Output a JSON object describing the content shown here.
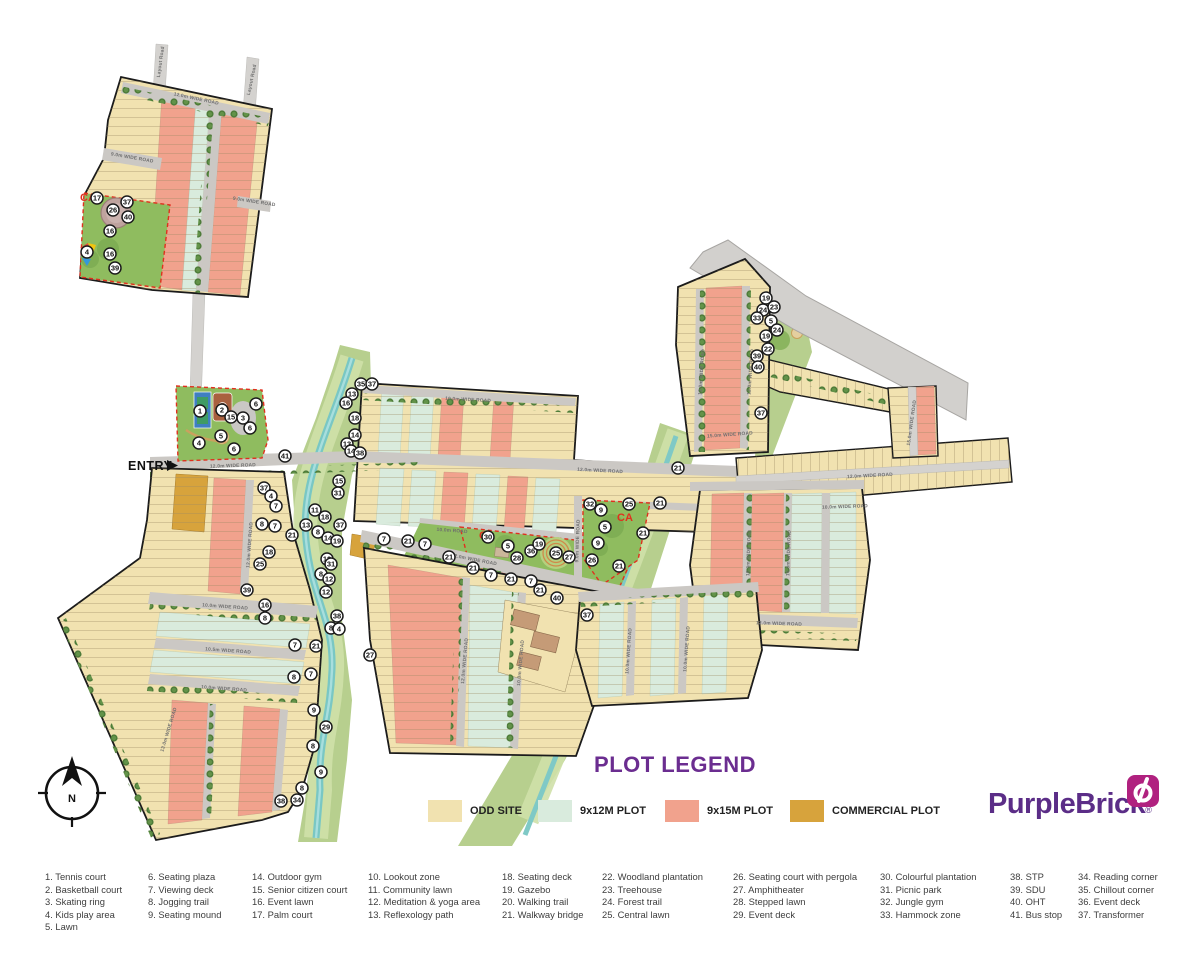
{
  "plot_legend": {
    "title": "PLOT LEGEND",
    "items": [
      {
        "label": "ODD SITE",
        "color": "#F1E2B0"
      },
      {
        "label": "9x12M PLOT",
        "color": "#D9EBDD"
      },
      {
        "label": "9x15M PLOT",
        "color": "#F1A28D"
      },
      {
        "label": "COMMERCIAL PLOT",
        "color": "#D7A33C"
      }
    ]
  },
  "brand": {
    "name": "PurpleBrick",
    "registered": "®",
    "purple": "#5B2D87",
    "magenta": "#B0217F"
  },
  "map": {
    "entry_label": "ENTRY",
    "north_label": "N",
    "ca_label": "CA",
    "ca_positions": [
      {
        "x": 80,
        "y": 201
      },
      {
        "x": 479,
        "y": 539
      },
      {
        "x": 617,
        "y": 521
      }
    ],
    "road_labels": [
      {
        "text": "Layout Road",
        "x": 162,
        "y": 62,
        "rot": -82
      },
      {
        "text": "Layout Road",
        "x": 253,
        "y": 80,
        "rot": -78
      },
      {
        "text": "12.0m WIDE ROAD",
        "x": 196,
        "y": 100,
        "rot": 12
      },
      {
        "text": "9.0m WIDE ROAD",
        "x": 132,
        "y": 159,
        "rot": 10
      },
      {
        "text": "9.0m WIDE ROAD",
        "x": 254,
        "y": 203,
        "rot": 9
      },
      {
        "text": "12.0m WIDE ROAD",
        "x": 233,
        "y": 467,
        "rot": -2
      },
      {
        "text": "12.0m WIDE ROAD",
        "x": 600,
        "y": 472,
        "rot": 3
      },
      {
        "text": "10.0m WIDE ROAD",
        "x": 468,
        "y": 401,
        "rot": 3
      },
      {
        "text": "12.0m WIDE ROAD",
        "x": 870,
        "y": 477,
        "rot": -3
      },
      {
        "text": "10.0m WIDE ROAD",
        "x": 845,
        "y": 508,
        "rot": -2
      },
      {
        "text": "10.0m ROAD",
        "x": 452,
        "y": 532,
        "rot": 4
      },
      {
        "text": "12.0m WIDE ROAD",
        "x": 474,
        "y": 561,
        "rot": 11
      },
      {
        "text": "10.0m WIDE ROAD",
        "x": 225,
        "y": 608,
        "rot": 4
      },
      {
        "text": "10.5m WIDE ROAD",
        "x": 228,
        "y": 652,
        "rot": 4
      },
      {
        "text": "10.0m WIDE ROAD",
        "x": 224,
        "y": 690,
        "rot": 4
      },
      {
        "text": "12.0m WIDE ROAD",
        "x": 251,
        "y": 545,
        "rot": -86
      },
      {
        "text": "13.0m WIDE ROAD",
        "x": 170,
        "y": 730,
        "rot": -73
      },
      {
        "text": "10.0m WIDE ROAD",
        "x": 750,
        "y": 553,
        "rot": -88
      },
      {
        "text": "10.0m WIDE ROAD",
        "x": 790,
        "y": 553,
        "rot": -88
      },
      {
        "text": "12.0m WIDE ROAD",
        "x": 779,
        "y": 625,
        "rot": 2
      },
      {
        "text": "12.0m WIDE ROAD",
        "x": 703,
        "y": 372,
        "rot": -86
      },
      {
        "text": "12.0m WIDE ROAD",
        "x": 752,
        "y": 372,
        "rot": -86
      },
      {
        "text": "15.0m WIDE ROAD",
        "x": 913,
        "y": 423,
        "rot": -82
      },
      {
        "text": "15.0m WIDE ROAD",
        "x": 730,
        "y": 436,
        "rot": -4
      },
      {
        "text": "10.0m WIDE ROAD",
        "x": 630,
        "y": 651,
        "rot": -86
      },
      {
        "text": "10.0m WIDE ROAD",
        "x": 688,
        "y": 649,
        "rot": -86
      },
      {
        "text": "12.0m WIDE ROAD",
        "x": 466,
        "y": 661,
        "rot": -85
      },
      {
        "text": "10.0m WIDE ROAD",
        "x": 522,
        "y": 663,
        "rot": -85
      },
      {
        "text": "9.0m WIDE ROAD",
        "x": 579,
        "y": 541,
        "rot": -88
      }
    ],
    "markers": [
      {
        "n": 17,
        "x": 97,
        "y": 198
      },
      {
        "n": 37,
        "x": 127,
        "y": 202
      },
      {
        "n": 26,
        "x": 113,
        "y": 210
      },
      {
        "n": 40,
        "x": 128,
        "y": 217
      },
      {
        "n": 16,
        "x": 110,
        "y": 231
      },
      {
        "n": 4,
        "x": 87,
        "y": 252
      },
      {
        "n": 16,
        "x": 110,
        "y": 254
      },
      {
        "n": 39,
        "x": 115,
        "y": 268
      },
      {
        "n": 1,
        "x": 200,
        "y": 411
      },
      {
        "n": 2,
        "x": 222,
        "y": 410
      },
      {
        "n": 15,
        "x": 231,
        "y": 417
      },
      {
        "n": 3,
        "x": 243,
        "y": 418
      },
      {
        "n": 6,
        "x": 256,
        "y": 404
      },
      {
        "n": 6,
        "x": 250,
        "y": 428
      },
      {
        "n": 4,
        "x": 199,
        "y": 443
      },
      {
        "n": 5,
        "x": 221,
        "y": 436
      },
      {
        "n": 6,
        "x": 234,
        "y": 449
      },
      {
        "n": 41,
        "x": 285,
        "y": 456
      },
      {
        "n": 35,
        "x": 361,
        "y": 384
      },
      {
        "n": 37,
        "x": 372,
        "y": 384
      },
      {
        "n": 13,
        "x": 352,
        "y": 394
      },
      {
        "n": 16,
        "x": 346,
        "y": 403
      },
      {
        "n": 18,
        "x": 355,
        "y": 418
      },
      {
        "n": 14,
        "x": 355,
        "y": 435
      },
      {
        "n": 13,
        "x": 347,
        "y": 444
      },
      {
        "n": 14,
        "x": 351,
        "y": 451
      },
      {
        "n": 38,
        "x": 360,
        "y": 453
      },
      {
        "n": 15,
        "x": 339,
        "y": 481
      },
      {
        "n": 31,
        "x": 338,
        "y": 493
      },
      {
        "n": 37,
        "x": 340,
        "y": 525
      },
      {
        "n": 11,
        "x": 315,
        "y": 510
      },
      {
        "n": 18,
        "x": 325,
        "y": 517
      },
      {
        "n": 13,
        "x": 306,
        "y": 525
      },
      {
        "n": 8,
        "x": 318,
        "y": 532
      },
      {
        "n": 14,
        "x": 328,
        "y": 538
      },
      {
        "n": 19,
        "x": 337,
        "y": 541
      },
      {
        "n": 12,
        "x": 327,
        "y": 559
      },
      {
        "n": 31,
        "x": 331,
        "y": 564
      },
      {
        "n": 8,
        "x": 321,
        "y": 574
      },
      {
        "n": 12,
        "x": 329,
        "y": 579
      },
      {
        "n": 12,
        "x": 326,
        "y": 592
      },
      {
        "n": 38,
        "x": 337,
        "y": 616
      },
      {
        "n": 8,
        "x": 331,
        "y": 628
      },
      {
        "n": 4,
        "x": 339,
        "y": 629
      },
      {
        "n": 37,
        "x": 264,
        "y": 488
      },
      {
        "n": 4,
        "x": 271,
        "y": 496
      },
      {
        "n": 7,
        "x": 276,
        "y": 506
      },
      {
        "n": 8,
        "x": 262,
        "y": 524
      },
      {
        "n": 7,
        "x": 275,
        "y": 526
      },
      {
        "n": 21,
        "x": 292,
        "y": 535
      },
      {
        "n": 18,
        "x": 269,
        "y": 552
      },
      {
        "n": 25,
        "x": 260,
        "y": 564
      },
      {
        "n": 39,
        "x": 247,
        "y": 590
      },
      {
        "n": 16,
        "x": 265,
        "y": 605
      },
      {
        "n": 8,
        "x": 265,
        "y": 618
      },
      {
        "n": 7,
        "x": 295,
        "y": 645
      },
      {
        "n": 21,
        "x": 316,
        "y": 646
      },
      {
        "n": 7,
        "x": 311,
        "y": 674
      },
      {
        "n": 8,
        "x": 294,
        "y": 677
      },
      {
        "n": 9,
        "x": 314,
        "y": 710
      },
      {
        "n": 29,
        "x": 326,
        "y": 727
      },
      {
        "n": 8,
        "x": 313,
        "y": 746
      },
      {
        "n": 9,
        "x": 321,
        "y": 772
      },
      {
        "n": 8,
        "x": 302,
        "y": 788
      },
      {
        "n": 38,
        "x": 281,
        "y": 801
      },
      {
        "n": 34,
        "x": 297,
        "y": 800
      },
      {
        "n": 27,
        "x": 370,
        "y": 655
      },
      {
        "n": 7,
        "x": 384,
        "y": 539
      },
      {
        "n": 21,
        "x": 408,
        "y": 541
      },
      {
        "n": 7,
        "x": 425,
        "y": 544
      },
      {
        "n": 21,
        "x": 449,
        "y": 557
      },
      {
        "n": 21,
        "x": 473,
        "y": 568
      },
      {
        "n": 7,
        "x": 491,
        "y": 575
      },
      {
        "n": 21,
        "x": 511,
        "y": 579
      },
      {
        "n": 7,
        "x": 531,
        "y": 581
      },
      {
        "n": 21,
        "x": 540,
        "y": 590
      },
      {
        "n": 40,
        "x": 557,
        "y": 598
      },
      {
        "n": 37,
        "x": 587,
        "y": 615
      },
      {
        "n": 30,
        "x": 488,
        "y": 537
      },
      {
        "n": 5,
        "x": 508,
        "y": 546
      },
      {
        "n": 36,
        "x": 531,
        "y": 551
      },
      {
        "n": 19,
        "x": 539,
        "y": 544
      },
      {
        "n": 25,
        "x": 556,
        "y": 553
      },
      {
        "n": 27,
        "x": 569,
        "y": 557
      },
      {
        "n": 28,
        "x": 517,
        "y": 558
      },
      {
        "n": 32,
        "x": 590,
        "y": 504
      },
      {
        "n": 9,
        "x": 601,
        "y": 510
      },
      {
        "n": 25,
        "x": 629,
        "y": 504
      },
      {
        "n": 5,
        "x": 605,
        "y": 527
      },
      {
        "n": 9,
        "x": 598,
        "y": 543
      },
      {
        "n": 26,
        "x": 592,
        "y": 560
      },
      {
        "n": 21,
        "x": 678,
        "y": 468
      },
      {
        "n": 21,
        "x": 660,
        "y": 503
      },
      {
        "n": 21,
        "x": 643,
        "y": 533
      },
      {
        "n": 21,
        "x": 619,
        "y": 566
      },
      {
        "n": 19,
        "x": 766,
        "y": 298
      },
      {
        "n": 24,
        "x": 763,
        "y": 310
      },
      {
        "n": 23,
        "x": 774,
        "y": 307
      },
      {
        "n": 33,
        "x": 757,
        "y": 318
      },
      {
        "n": 5,
        "x": 771,
        "y": 321
      },
      {
        "n": 24,
        "x": 777,
        "y": 330
      },
      {
        "n": 19,
        "x": 766,
        "y": 336
      },
      {
        "n": 22,
        "x": 768,
        "y": 349
      },
      {
        "n": 39,
        "x": 757,
        "y": 356
      },
      {
        "n": 40,
        "x": 758,
        "y": 367
      },
      {
        "n": 37,
        "x": 761,
        "y": 413
      }
    ]
  },
  "amenity_legend": {
    "columns": [
      [
        "1. Tennis court",
        "2. Basketball court",
        "3. Skating ring",
        "4. Kids play area",
        "5. Lawn"
      ],
      [
        "6. Seating plaza",
        "7. Viewing deck",
        "8. Jogging trail",
        "9. Seating mound"
      ],
      [
        "14. Outdoor gym",
        "15. Senior citizen court",
        "16. Event lawn",
        "17. Palm court"
      ],
      [
        "10. Lookout zone",
        "11. Community lawn",
        "12. Meditation & yoga area",
        "13. Reflexology path"
      ],
      [
        "18. Seating deck",
        "19. Gazebo",
        "20. Walking trail",
        "21. Walkway bridge"
      ],
      [
        "22. Woodland plantation",
        "23. Treehouse",
        "24. Forest trail",
        "25. Central lawn"
      ],
      [
        "26. Seating court with pergola",
        "27. Amphitheater",
        "28. Stepped lawn",
        "29. Event deck"
      ],
      [
        "30. Colourful plantation",
        "31. Picnic park",
        "32. Jungle gym",
        "33. Hammock zone"
      ],
      [
        "38. STP",
        "39. SDU",
        "40. OHT",
        "41. Bus stop"
      ],
      [
        "34. Reading corner",
        "35. Chillout corner",
        "36. Event deck",
        "37. Transformer"
      ]
    ]
  }
}
